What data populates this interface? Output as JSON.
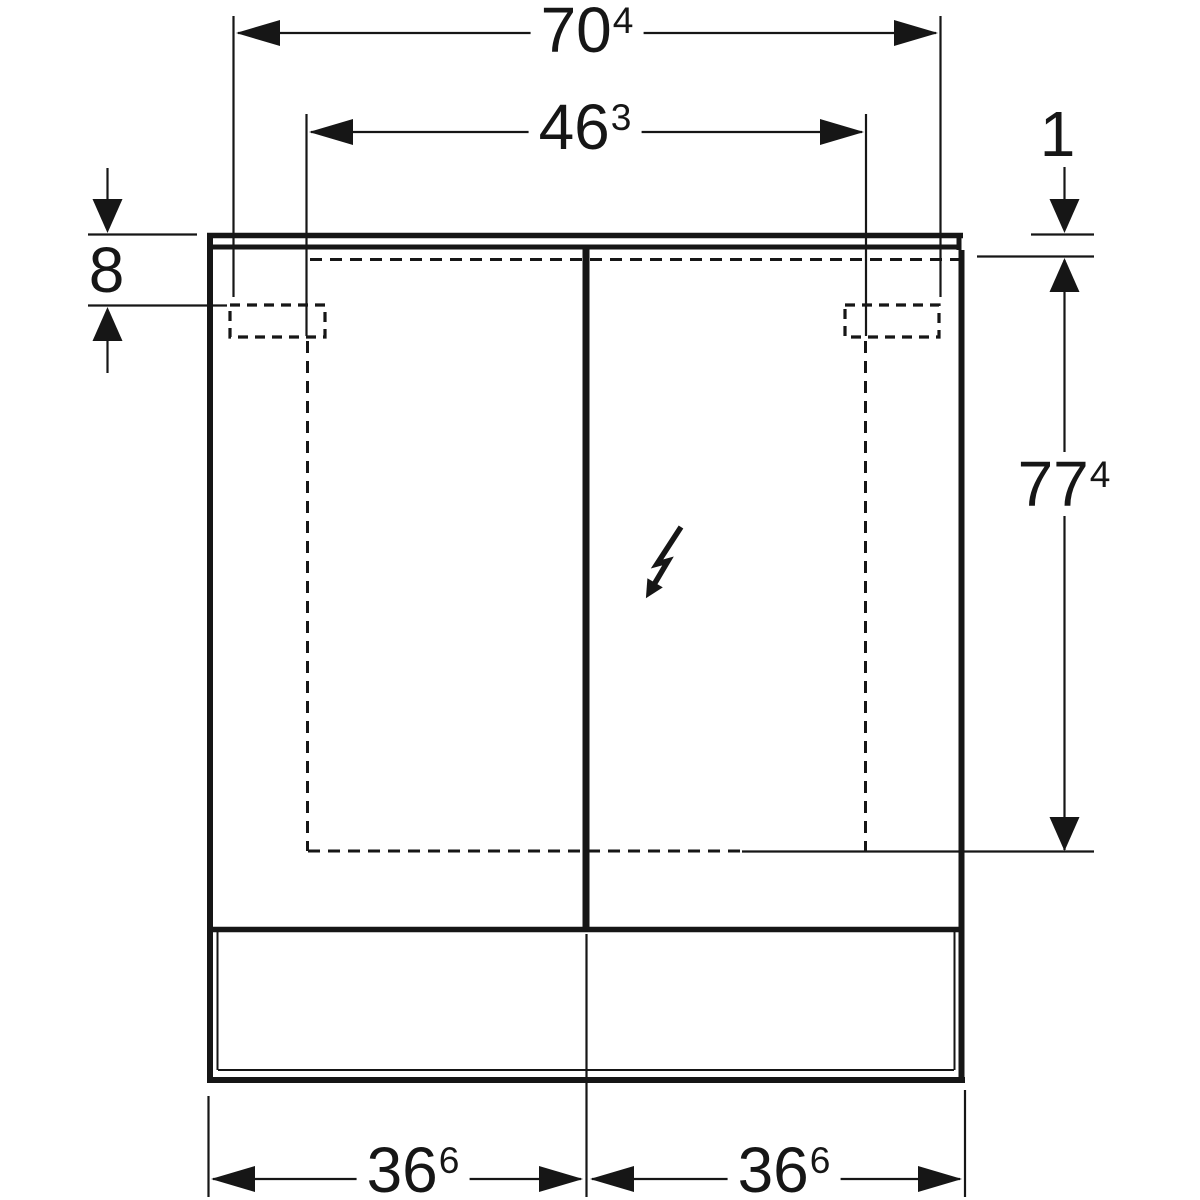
{
  "drawing": {
    "type": "technical-dimension-drawing",
    "subject": "double-door mirror cabinet with light panel, front view",
    "background_color": "#ffffff",
    "line_color": "#161616",
    "dimensions": {
      "overall_width": {
        "value": "70",
        "exp": "4"
      },
      "fixing_centres_width": {
        "value": "46",
        "exp": "3"
      },
      "top_panel_height": {
        "value": "1",
        "exp": ""
      },
      "fixing_offset_from_top": {
        "value": "8",
        "exp": ""
      },
      "cabinet_height": {
        "value": "77",
        "exp": "4"
      },
      "left_door_width": {
        "value": "36",
        "exp": "6"
      },
      "right_door_width": {
        "value": "36",
        "exp": "6"
      }
    },
    "icons": {
      "power_symbol": "lightning-arrow-icon"
    }
  }
}
